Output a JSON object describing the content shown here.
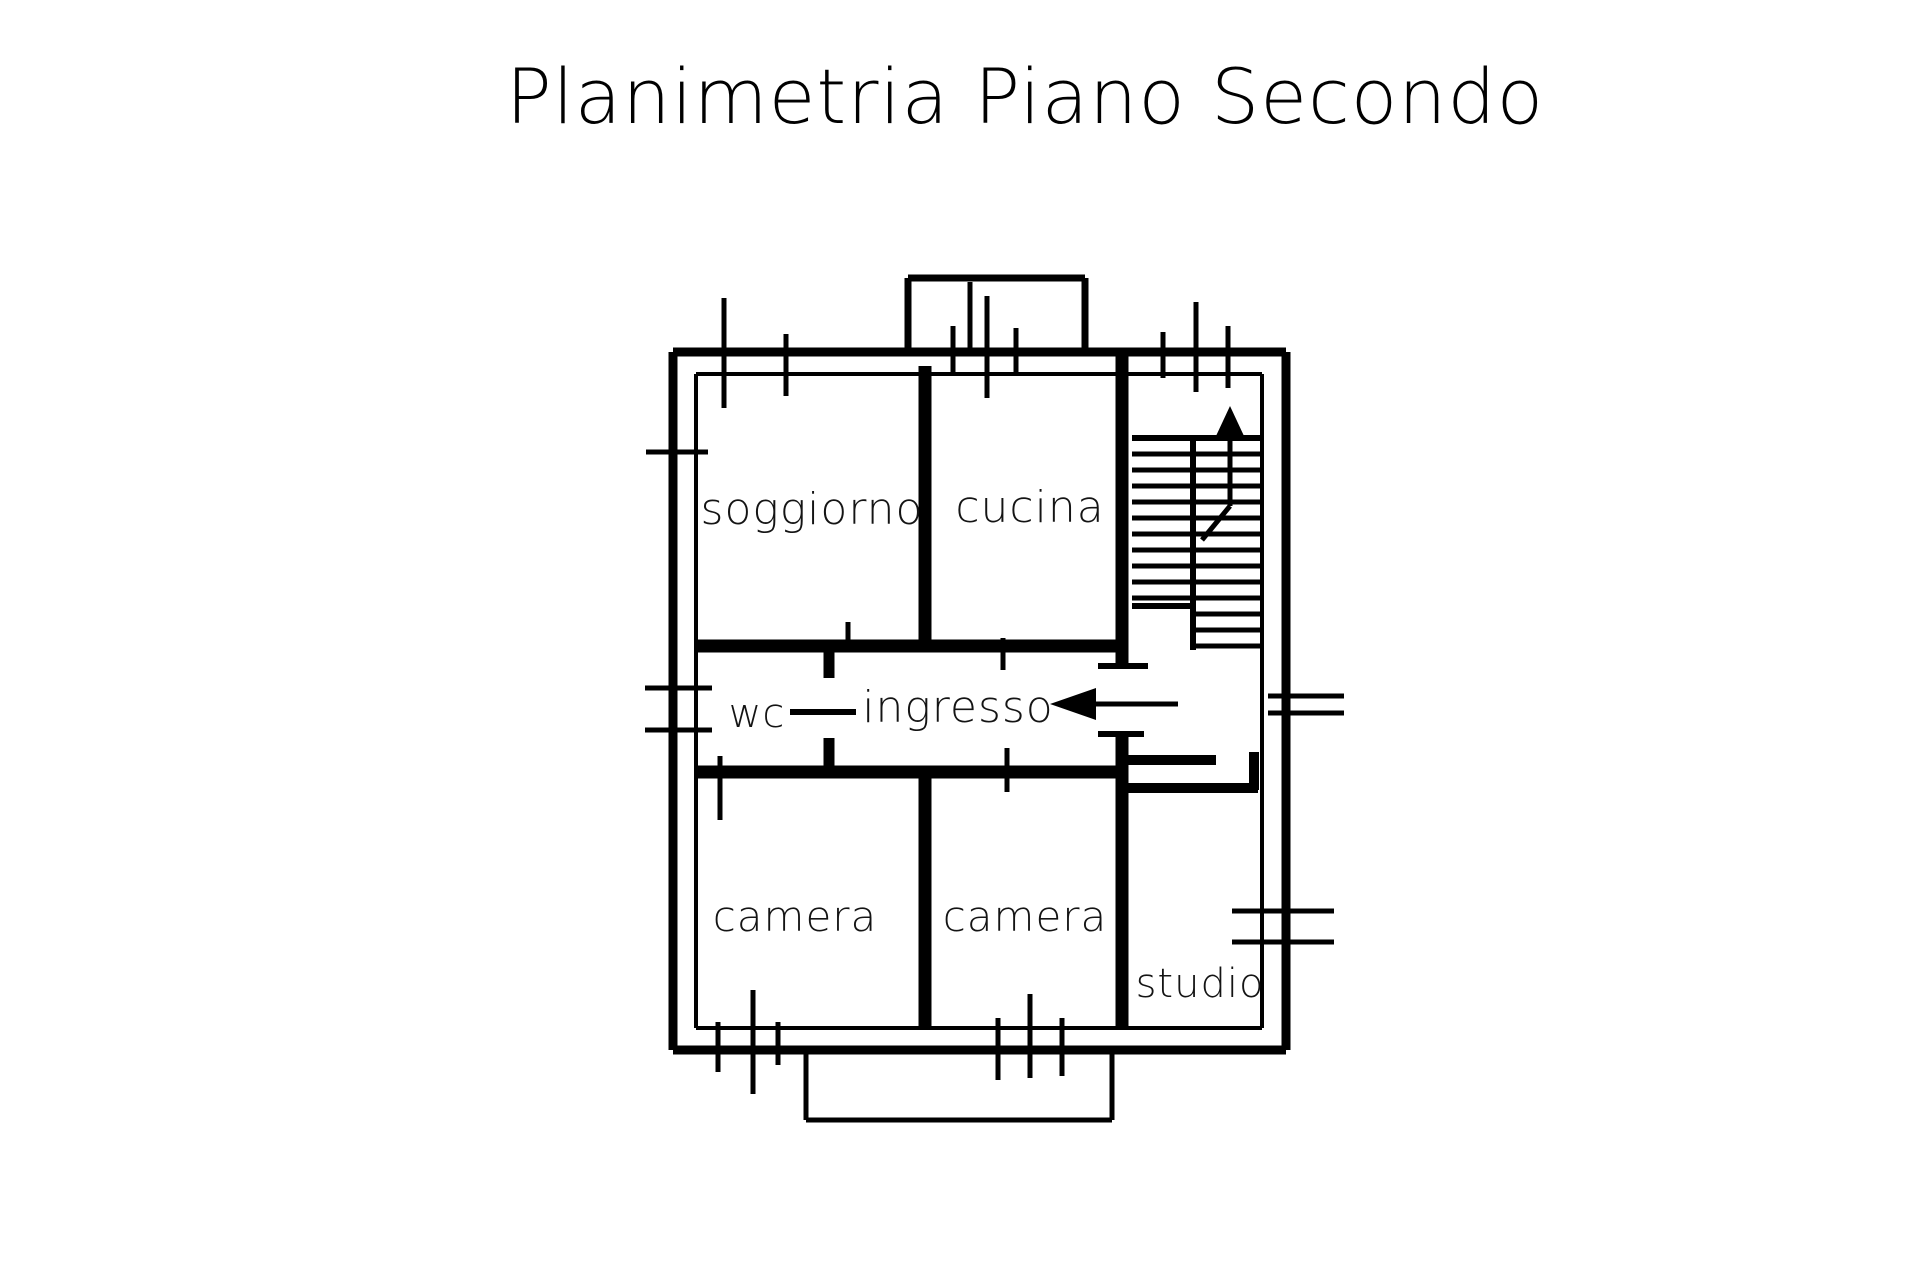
{
  "title": "Planimetria Piano Secondo",
  "plan": {
    "background": "#ffffff",
    "ink_color": "#000000",
    "rooms": [
      {
        "id": "soggiorno",
        "label": "soggiorno",
        "x": 812,
        "y": 524,
        "size": 44
      },
      {
        "id": "cucina",
        "label": "cucina",
        "x": 1030,
        "y": 522,
        "size": 44
      },
      {
        "id": "wc",
        "label": "wc",
        "x": 757,
        "y": 727,
        "size": 40
      },
      {
        "id": "ingresso",
        "label": "ingresso",
        "x": 958,
        "y": 722,
        "size": 44
      },
      {
        "id": "camera-1",
        "label": "camera",
        "x": 795,
        "y": 931,
        "size": 42
      },
      {
        "id": "camera-2",
        "label": "camera",
        "x": 1025,
        "y": 931,
        "size": 42
      },
      {
        "id": "studio",
        "label": "studio",
        "x": 1200,
        "y": 997,
        "size": 40
      }
    ],
    "annotations": [
      {
        "id": "entrance-arrow",
        "meaning": "entrance direction into ingresso",
        "direction": "left"
      },
      {
        "id": "stairs-up-arrow",
        "meaning": "staircase going up",
        "direction": "up"
      }
    ]
  }
}
